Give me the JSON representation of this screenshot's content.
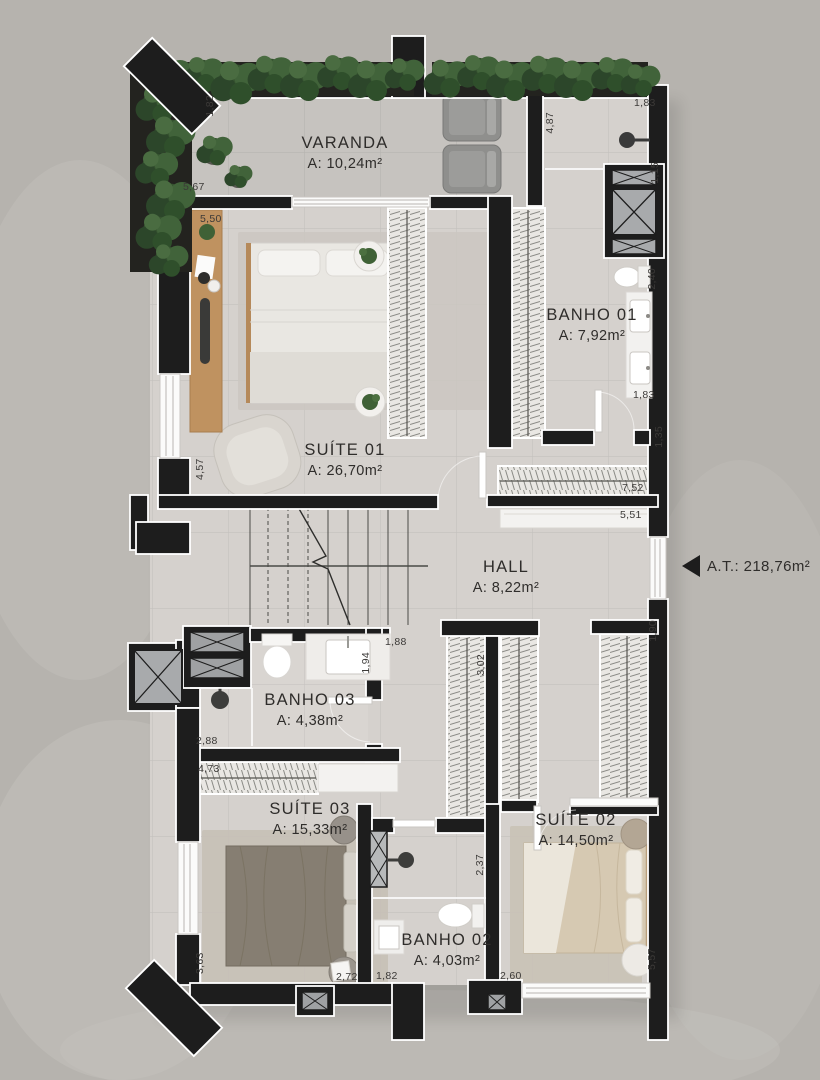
{
  "rooms": {
    "varanda": {
      "name": "VARANDA",
      "area": "A: 10,24m²"
    },
    "banho01": {
      "name": "BANHO 01",
      "area": "A: 7,92m²"
    },
    "suite01": {
      "name": "SUÍTE 01",
      "area": "A: 26,70m²"
    },
    "hall": {
      "name": "HALL",
      "area": "A: 8,22m²"
    },
    "banho03": {
      "name": "BANHO 03",
      "area": "A: 4,38m²"
    },
    "suite03": {
      "name": "SUÍTE 03",
      "area": "A: 15,33m²"
    },
    "suite02": {
      "name": "SUÍTE 02",
      "area": "A: 14,50m²"
    },
    "banho02": {
      "name": "BANHO 02",
      "area": "A: 4,03m²"
    }
  },
  "annotation": {
    "total_area": "A.T.: 218,76m²"
  },
  "dims": [
    "1,82",
    "5,67",
    "5,50",
    "4,87",
    "1,83",
    "1,15",
    "2,40",
    "1,83",
    "1,35",
    "7,52",
    "5,51",
    "1,90",
    "4,57",
    "1,94",
    "1,88",
    "3,02",
    "2,88",
    "4,73",
    "2,37",
    "3,63",
    "2,72",
    "1,82",
    "2,60",
    "5,57"
  ],
  "colors": {
    "wall": "#1d1d1d",
    "floor": "#d5d1cd",
    "varanda_floor": "#c6c3bf",
    "outside": "#b6b3ae",
    "plant": "#3a5a34",
    "wood": "#bf9260",
    "closet": "#e9e7e3"
  }
}
